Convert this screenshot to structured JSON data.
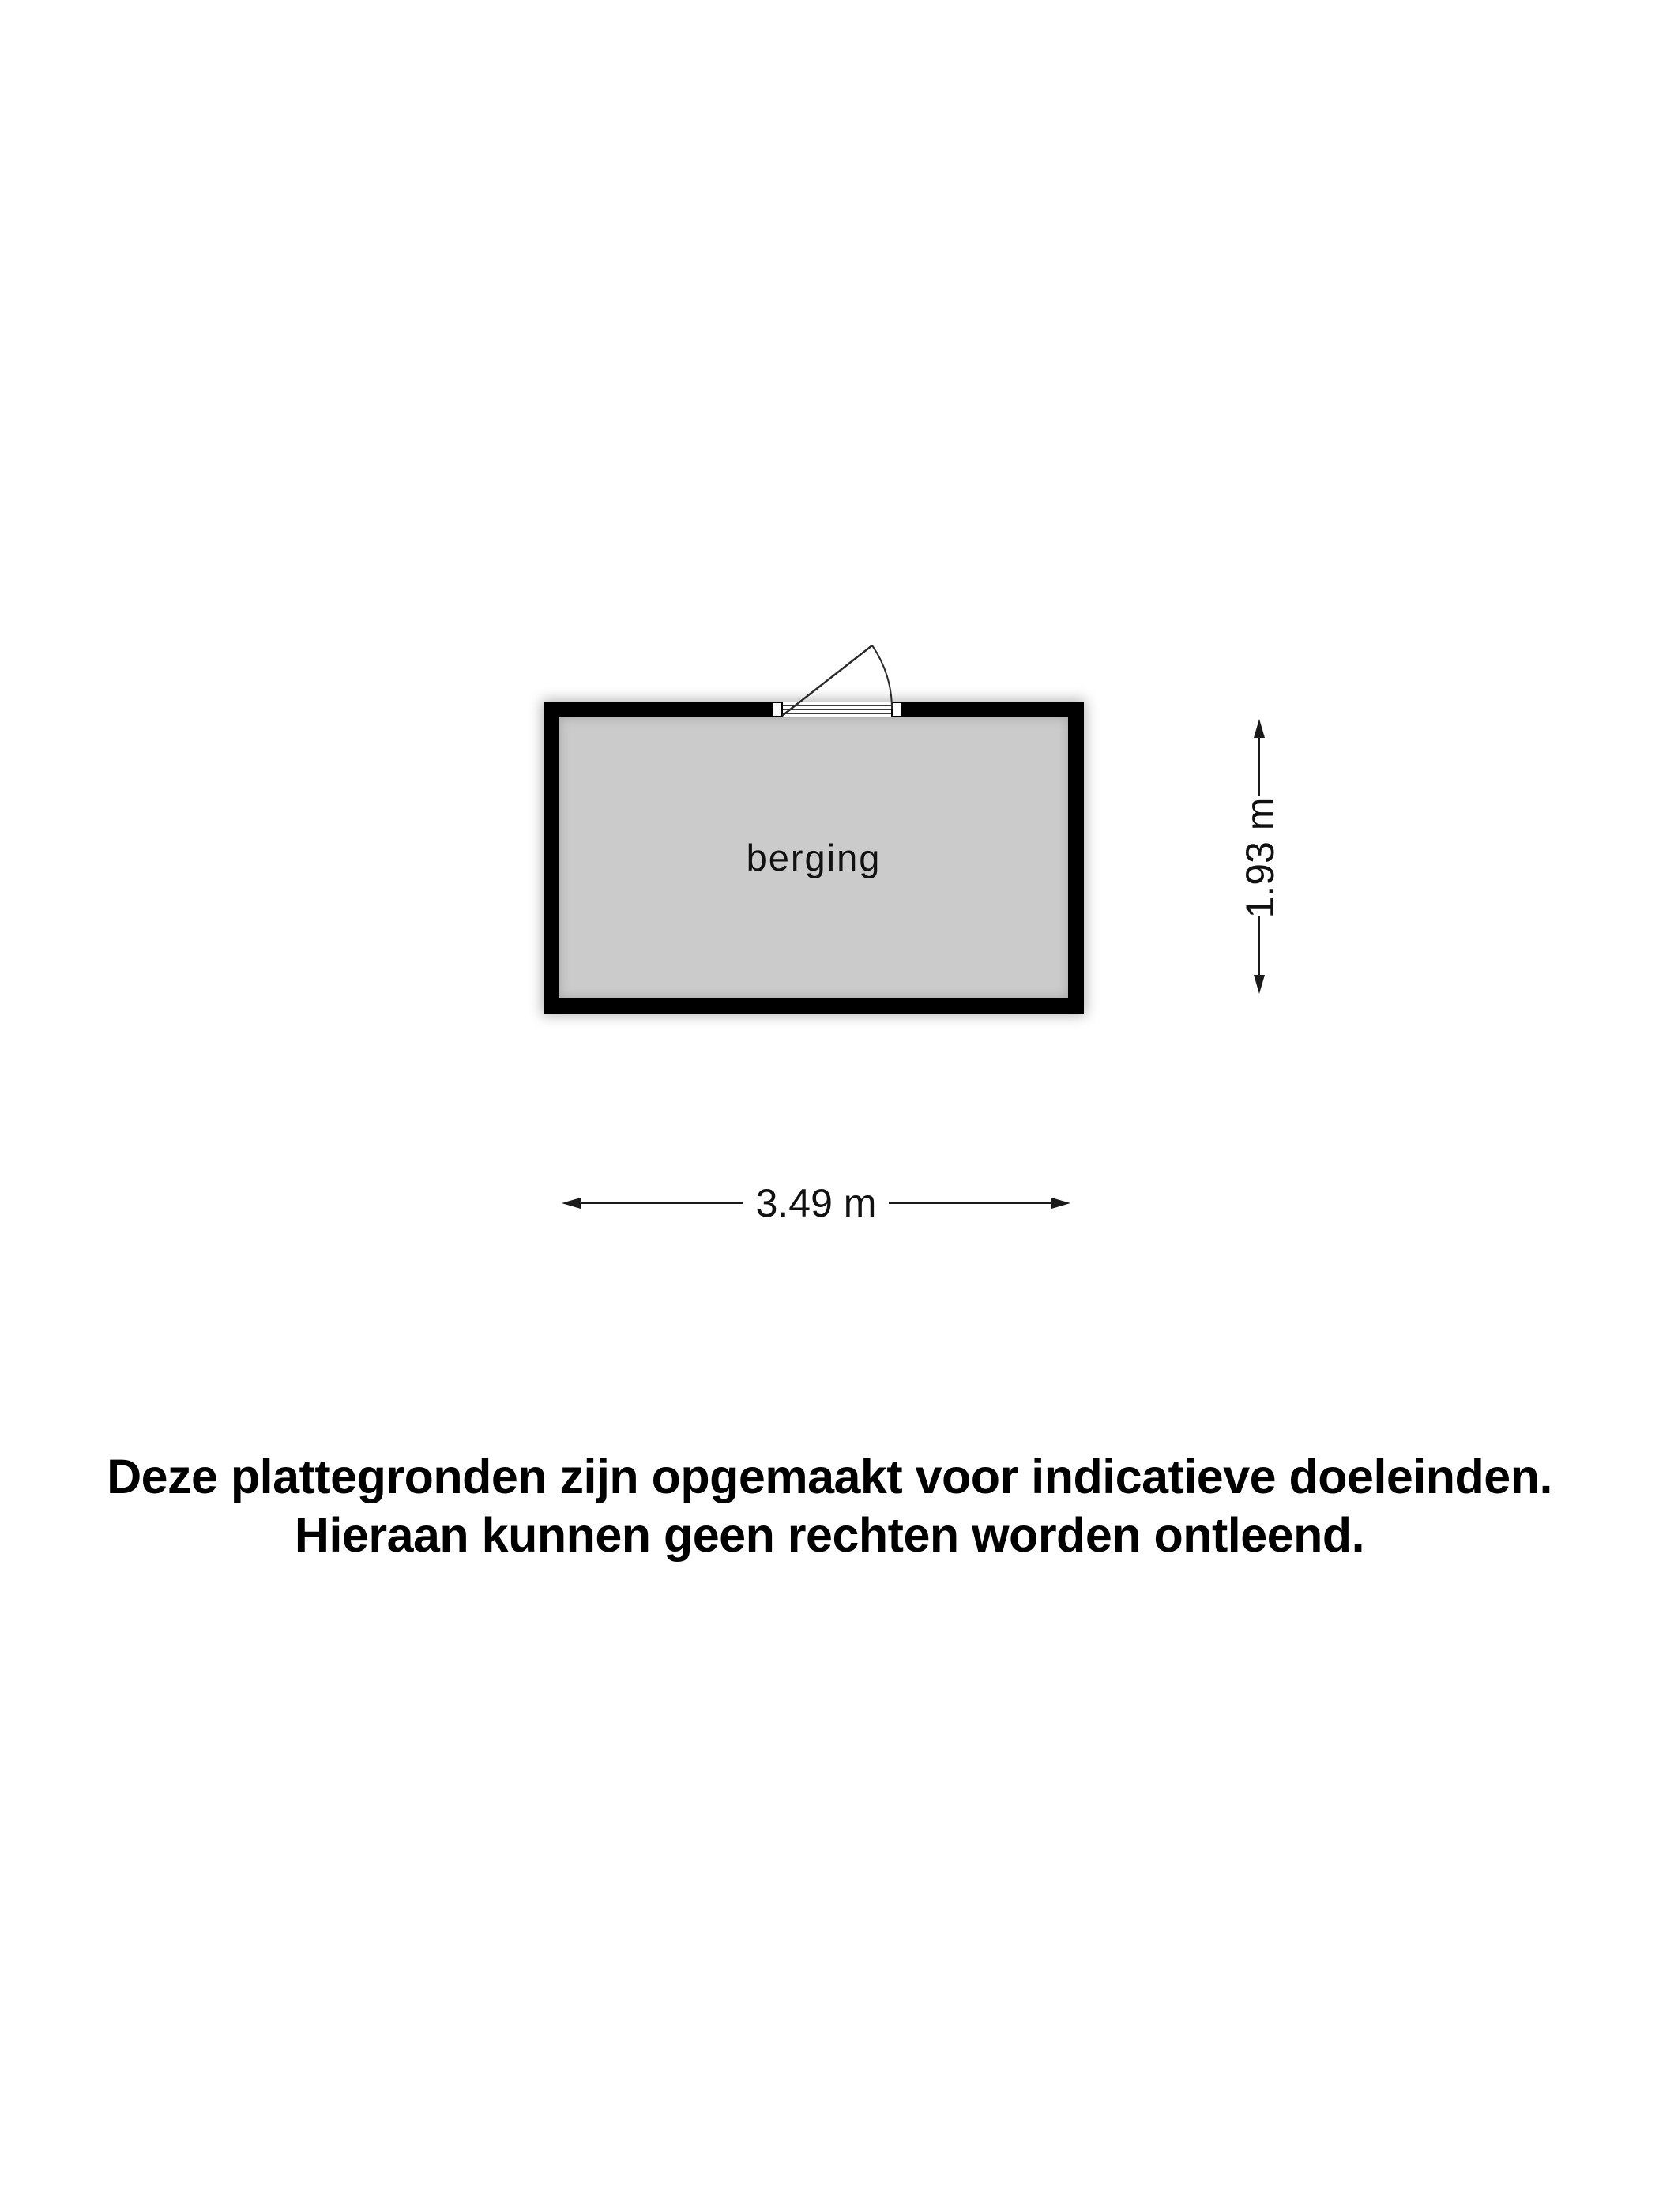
{
  "floor_plan": {
    "room_label": "berging",
    "width_dimension": "3.49 m",
    "height_dimension": "1.93 m"
  },
  "disclaimer": {
    "line1": "Deze plattegronden zijn opgemaakt voor indicatieve doeleinden.",
    "line2": "Hieraan kunnen geen rechten worden ontleend."
  },
  "colors": {
    "wall": "#000000",
    "room_fill": "#cbcbcb",
    "background": "#ffffff",
    "line": "#1a1a1a",
    "text": "#111111"
  }
}
